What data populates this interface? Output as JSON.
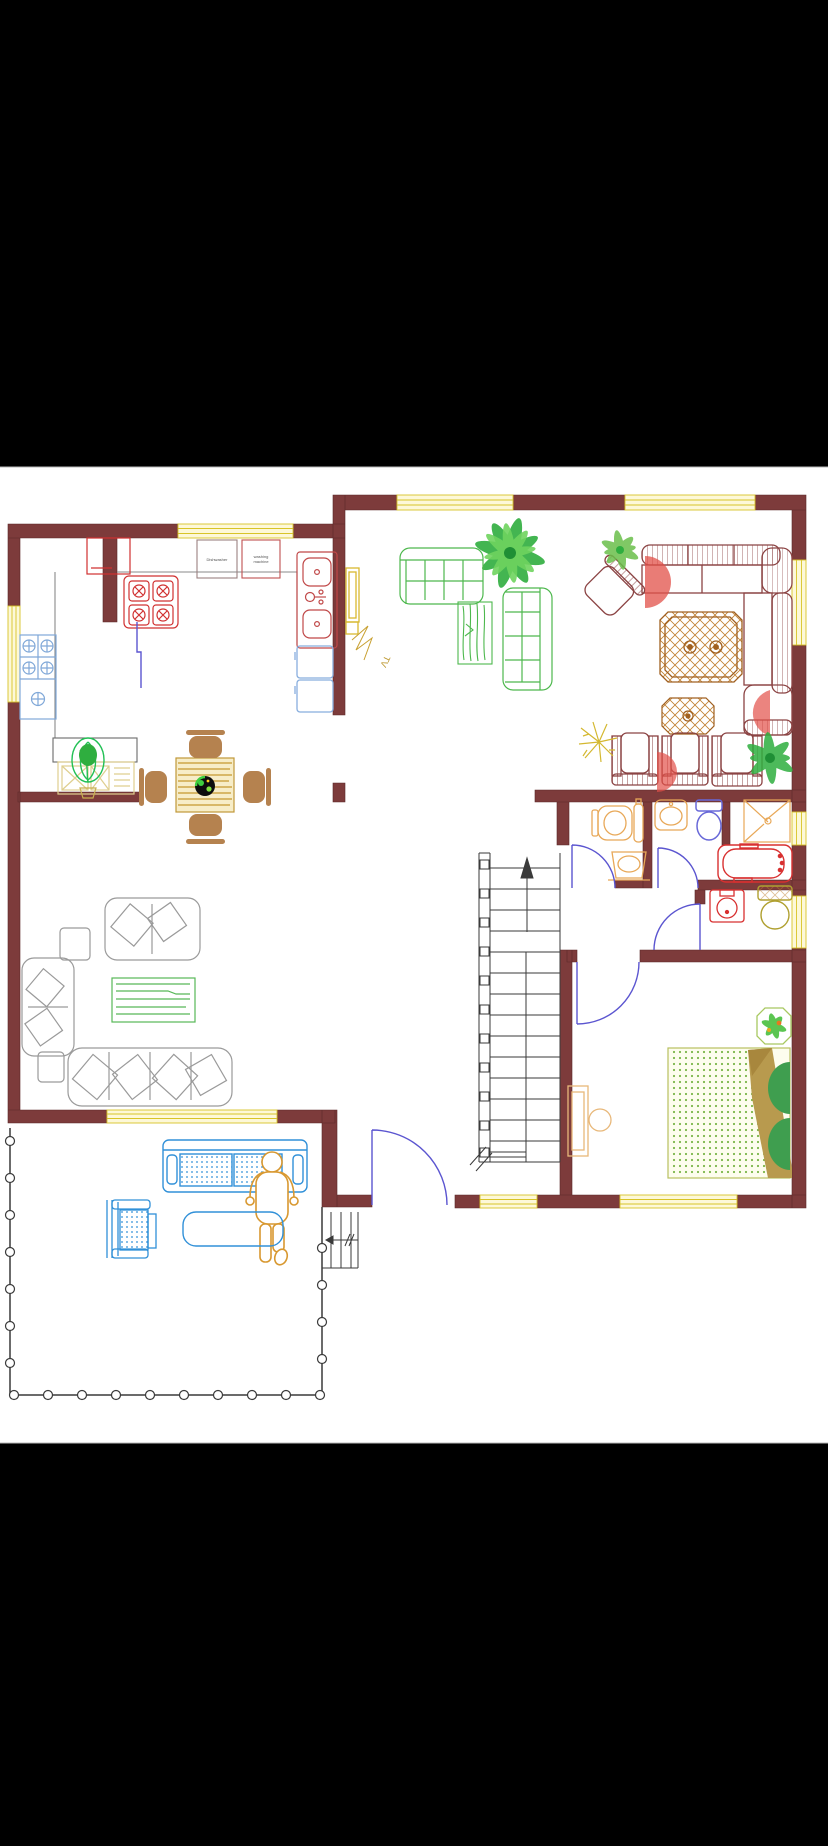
{
  "image": {
    "kind": "floor-plan-drawing",
    "letterbox_color": "#000000",
    "canvas_color": "#ffffff"
  },
  "labels": {
    "dishwasher": "Dishwasher",
    "washing_machine_line1": "washing",
    "washing_machine_line2": "machine",
    "tv": "TV"
  },
  "palette": {
    "wall": "#7d3b3b",
    "wall_edge": "#5a2828",
    "window_fill": "#fdf8d8",
    "window_line": "#d8c428",
    "door_arc": "#5b55d0",
    "gray_furniture": "#9a9a9a",
    "green_furniture": "#4db84d",
    "maroon_furniture": "#8b4343",
    "brown_table": "#a06020",
    "red_fixture": "#d83030",
    "orange_fixture": "#e8a858",
    "blue_fixture": "#6868d8",
    "light_blue": "#3090d8",
    "pale_blue": "#88aede",
    "olive_fixture": "#b0a030",
    "chair_brown": "#b5824f",
    "plant_green": "#2fae3f",
    "person_orange": "#d89830",
    "stair_line": "#3a3a3a",
    "tan_blanket": "#b89a4e"
  }
}
